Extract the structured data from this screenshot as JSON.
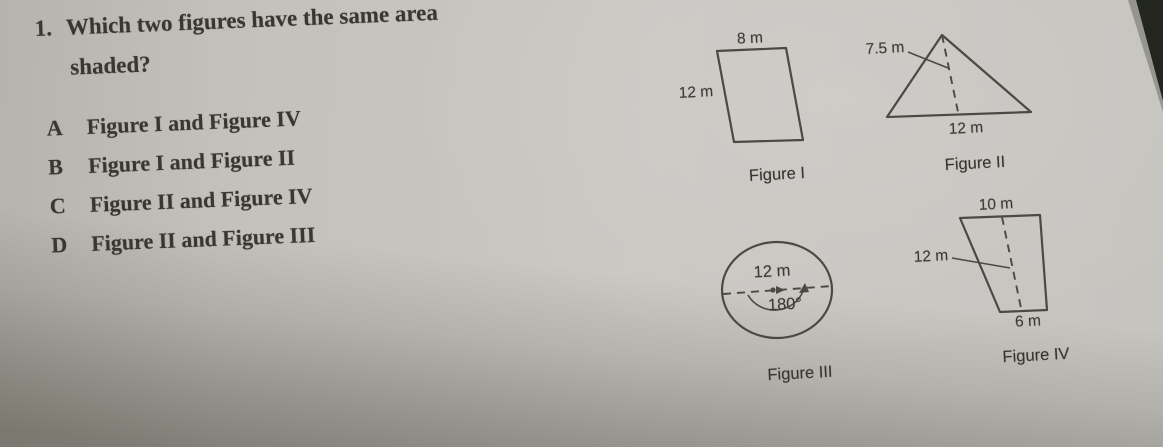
{
  "question": {
    "number": "1.",
    "line1": "Which two figures have the same area",
    "line2": "shaded?",
    "options": [
      {
        "letter": "A",
        "text": "Figure I and Figure IV"
      },
      {
        "letter": "B",
        "text": "Figure I and Figure II"
      },
      {
        "letter": "C",
        "text": "Figure II and Figure IV"
      },
      {
        "letter": "D",
        "text": "Figure II and Figure III"
      }
    ]
  },
  "figures": {
    "fig1": {
      "type": "rectangle",
      "top": "8 m",
      "left": "12 m",
      "caption": "Figure I"
    },
    "fig2": {
      "type": "triangle",
      "height": "7.5 m",
      "base": "12 m",
      "caption": "Figure II"
    },
    "fig3": {
      "type": "circle",
      "diameter": "12 m",
      "angle": "180°",
      "caption": "Figure III"
    },
    "fig4": {
      "type": "trapezoid",
      "top": "10 m",
      "height": "12 m",
      "bottom": "6 m",
      "caption": "Figure IV"
    }
  },
  "colors": {
    "paper": "#c7c5c0",
    "ink": "#383732",
    "line": "#4a4942",
    "bottom_shadow": "#7d7c72",
    "corner_background": "#23261f"
  }
}
